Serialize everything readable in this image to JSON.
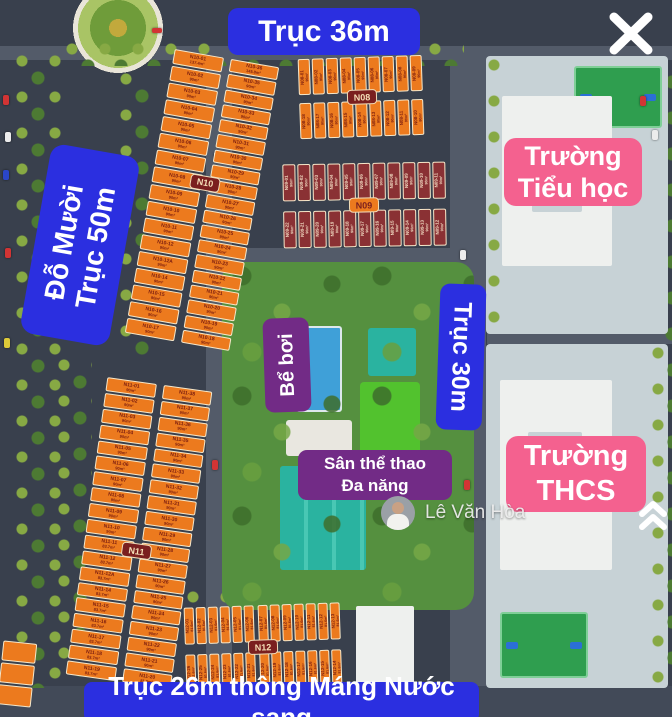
{
  "overlays": {
    "axis_top": "Trục 36m",
    "axis_left_line1": "Đỗ Mười",
    "axis_left_line2": "Trục 50m",
    "axis_right": "Trục 30m",
    "axis_bottom": "Trục 26m thông Máng Nước sang",
    "primary_school_line1": "Trường",
    "primary_school_line2": "Tiểu học",
    "secondary_school_line1": "Trường",
    "secondary_school_line2": "THCS",
    "pool": "Bể bơi",
    "sports_line1": "Sân thể thao",
    "sports_line2": "Đa năng",
    "watermark_name": "Lê Văn Hòa"
  },
  "blocks": {
    "n10": {
      "badge": "N10",
      "left": [
        {
          "id": "N10-01",
          "area": "137.4m²"
        },
        {
          "id": "N10-02",
          "area": "90m²"
        },
        {
          "id": "N10-03",
          "area": "90m²"
        },
        {
          "id": "N10-04",
          "area": "90m²"
        },
        {
          "id": "N10-05",
          "area": "90m²"
        },
        {
          "id": "N10-06",
          "area": "90m²"
        },
        {
          "id": "N10-07",
          "area": "90m²"
        },
        {
          "id": "N10-08",
          "area": "90m²"
        },
        {
          "id": "N10-09",
          "area": "90m²"
        },
        {
          "id": "N10-10",
          "area": "90m²"
        },
        {
          "id": "N10-11",
          "area": "90m²"
        },
        {
          "id": "N10-12",
          "area": "90m²"
        },
        {
          "id": "N10-12A",
          "area": "90m²"
        },
        {
          "id": "N10-14",
          "area": "90m²"
        },
        {
          "id": "N10-15",
          "area": "90m²"
        },
        {
          "id": "N10-16",
          "area": "90m²"
        },
        {
          "id": "N10-17",
          "area": "90m²"
        }
      ],
      "right": [
        {
          "id": "N10-36",
          "area": "145.8m²"
        },
        {
          "id": "N10-35",
          "area": "90m²"
        },
        {
          "id": "N10-34",
          "area": "90m²"
        },
        {
          "id": "N10-33",
          "area": "90m²"
        },
        {
          "id": "N10-32",
          "area": "90m²"
        },
        {
          "id": "N10-31",
          "area": "90m²"
        },
        {
          "id": "N10-30",
          "area": "90m²"
        },
        {
          "id": "N10-29",
          "area": "90m²"
        },
        {
          "id": "N10-28",
          "area": "90m²"
        },
        {
          "id": "N10-27",
          "area": "90m²"
        },
        {
          "id": "N10-26",
          "area": "90m²"
        },
        {
          "id": "N10-25",
          "area": "90m²"
        },
        {
          "id": "N10-24",
          "area": "90m²"
        },
        {
          "id": "N10-23",
          "area": "90m²"
        },
        {
          "id": "N10-22",
          "area": "90m²"
        },
        {
          "id": "N10-21",
          "area": "90m²"
        },
        {
          "id": "N10-20",
          "area": "90m²"
        },
        {
          "id": "N10-19",
          "area": "90m²"
        },
        {
          "id": "N10-18",
          "area": "90m²"
        }
      ]
    },
    "n11": {
      "badge": "N11",
      "left": [
        {
          "id": "N11-01",
          "area": "90m²"
        },
        {
          "id": "N11-02",
          "area": "90m²"
        },
        {
          "id": "N11-03",
          "area": "90m²"
        },
        {
          "id": "N11-04",
          "area": "90m²"
        },
        {
          "id": "N11-05",
          "area": "90m²"
        },
        {
          "id": "N11-06",
          "area": "90m²"
        },
        {
          "id": "N11-07",
          "area": "90m²"
        },
        {
          "id": "N11-08",
          "area": "90m²"
        },
        {
          "id": "N11-09",
          "area": "90m²"
        },
        {
          "id": "N11-10",
          "area": "90m²"
        },
        {
          "id": "N11-11",
          "area": "83.7m²"
        },
        {
          "id": "N11-12",
          "area": "83.7m²"
        },
        {
          "id": "N11-12A",
          "area": "83.7m²"
        },
        {
          "id": "N11-14",
          "area": "83.7m²"
        },
        {
          "id": "N11-15",
          "area": "83.7m²"
        },
        {
          "id": "N11-16",
          "area": "83.7m²"
        },
        {
          "id": "N11-17",
          "area": "83.7m²"
        },
        {
          "id": "N11-18",
          "area": "83.7m²"
        },
        {
          "id": "N11-19",
          "area": "83.7m²"
        }
      ],
      "right": [
        {
          "id": "N11-38",
          "area": "90m²"
        },
        {
          "id": "N11-37",
          "area": "90m²"
        },
        {
          "id": "N11-36",
          "area": "90m²"
        },
        {
          "id": "N11-35",
          "area": "90m²"
        },
        {
          "id": "N11-34",
          "area": "90m²"
        },
        {
          "id": "N11-33",
          "area": "90m²"
        },
        {
          "id": "N11-32",
          "area": "90m²"
        },
        {
          "id": "N11-31",
          "area": "90m²"
        },
        {
          "id": "N11-30",
          "area": "90m²"
        },
        {
          "id": "N11-29",
          "area": "90m²"
        },
        {
          "id": "N11-28",
          "area": "90m²"
        },
        {
          "id": "N11-27",
          "area": "90m²"
        },
        {
          "id": "N11-26",
          "area": "90m²"
        },
        {
          "id": "N11-25",
          "area": "90m²"
        },
        {
          "id": "N11-24",
          "area": "90m²"
        },
        {
          "id": "N11-23",
          "area": "90m²"
        },
        {
          "id": "N11-22",
          "area": "90m²"
        },
        {
          "id": "N11-21",
          "area": "90m²"
        },
        {
          "id": "N11-20",
          "area": "81.6m²"
        }
      ]
    },
    "n08": {
      "badge": "N08",
      "top": [
        {
          "id": "N08-01",
          "area": "90m²"
        },
        {
          "id": "N08-02",
          "area": "90m²"
        },
        {
          "id": "N08-03",
          "area": "90m²"
        },
        {
          "id": "N08-04",
          "area": "90m²"
        },
        {
          "id": "N08-05",
          "area": "90m²"
        },
        {
          "id": "N08-06",
          "area": "90m²"
        },
        {
          "id": "N08-07",
          "area": "90m²"
        },
        {
          "id": "N08-08",
          "area": "90m²"
        },
        {
          "id": "N08-09",
          "area": "90m²"
        }
      ],
      "bottom": [
        {
          "id": "N08-18",
          "area": "90m²"
        },
        {
          "id": "N08-17",
          "area": "90m²"
        },
        {
          "id": "N08-16",
          "area": "90m²"
        },
        {
          "id": "N08-15",
          "area": "90m²"
        },
        {
          "id": "N08-14",
          "area": "90m²"
        },
        {
          "id": "N08-13",
          "area": "90m²"
        },
        {
          "id": "N08-12",
          "area": "90m²"
        },
        {
          "id": "N08-11",
          "area": "90m²"
        },
        {
          "id": "N08-10",
          "area": "90m²"
        }
      ]
    },
    "n09": {
      "badge": "N09",
      "top_left": [
        {
          "id": "N09-01",
          "area": "90m²"
        },
        {
          "id": "N09-02",
          "area": "90m²"
        },
        {
          "id": "N09-03",
          "area": "90m²"
        },
        {
          "id": "N09-04",
          "area": "90m²"
        },
        {
          "id": "N09-05",
          "area": "90m²"
        }
      ],
      "top_right": [
        {
          "id": "N09-06",
          "area": "90m²"
        },
        {
          "id": "N09-07",
          "area": "90m²"
        },
        {
          "id": "N09-08",
          "area": "90m²"
        },
        {
          "id": "N09-09",
          "area": "90m²"
        },
        {
          "id": "N09-10",
          "area": "90m²"
        },
        {
          "id": "N09-11",
          "area": "90m²"
        }
      ],
      "bottom_left": [
        {
          "id": "N09-22",
          "area": "90m²"
        },
        {
          "id": "N09-21",
          "area": "90m²"
        },
        {
          "id": "N09-20",
          "area": "90m²"
        },
        {
          "id": "N09-19",
          "area": "90m²"
        },
        {
          "id": "N09-18",
          "area": "90m²"
        }
      ],
      "bottom_right": [
        {
          "id": "N09-17",
          "area": "90m²"
        },
        {
          "id": "N09-16",
          "area": "90m²"
        },
        {
          "id": "N09-15",
          "area": "90m²"
        },
        {
          "id": "N09-14",
          "area": "90m²"
        },
        {
          "id": "N09-13",
          "area": "90m²"
        },
        {
          "id": "N09-12",
          "area": "90m²"
        }
      ]
    },
    "n12": {
      "badge": "N12",
      "top_left": [
        {
          "id": "N12-01",
          "area": "81.6m²"
        },
        {
          "id": "N12-02",
          "area": "81.6m²"
        },
        {
          "id": "N12-03",
          "area": "81.6m²"
        },
        {
          "id": "N12-04",
          "area": "81.6m²"
        },
        {
          "id": "N12-05",
          "area": "81.6m²"
        },
        {
          "id": "N12-06",
          "area": "81.6m²"
        }
      ],
      "top_right": [
        {
          "id": "N12-07",
          "area": "81.6m²"
        },
        {
          "id": "N12-08",
          "area": "81.6m²"
        },
        {
          "id": "N12-09",
          "area": "81.6m²"
        },
        {
          "id": "N12-10",
          "area": "81.6m²"
        },
        {
          "id": "N12-11",
          "area": "81.6m²"
        },
        {
          "id": "N12-12",
          "area": "81.6m²"
        },
        {
          "id": "N12-13",
          "area": "81.6m²"
        }
      ],
      "bottom_left": [
        {
          "id": "N12-26",
          "area": "81.6m²"
        },
        {
          "id": "N12-25",
          "area": "81.6m²"
        },
        {
          "id": "N12-24",
          "area": "81.6m²"
        },
        {
          "id": "N12-23",
          "area": "81.6m²"
        },
        {
          "id": "N12-22",
          "area": "81.6m²"
        },
        {
          "id": "N12-21",
          "area": "81.6m²"
        }
      ],
      "bottom_right": [
        {
          "id": "N12-20",
          "area": "81.6m²"
        },
        {
          "id": "N12-19",
          "area": "81.6m²"
        },
        {
          "id": "N12-18",
          "area": "81.6m²"
        },
        {
          "id": "N12-17",
          "area": "81.6m²"
        },
        {
          "id": "N12-16",
          "area": "81.6m²"
        },
        {
          "id": "N12-15",
          "area": "81.6m²"
        },
        {
          "id": "N12-14",
          "area": "81.6m²"
        }
      ]
    }
  },
  "colors": {
    "axis_badge": "#2b2fe0",
    "school_badge": "#f4618f",
    "amenity_badge": "#722b86",
    "lot_orange": "#ec7a1e",
    "lot_orange_border": "#f6e7c9",
    "lot_text_maroon": "#7b1d10",
    "lot_maroon": "#8a3134",
    "lot_maroon_text": "#f3ddc4",
    "block_chip": "#7a1f1f",
    "park_green": "#55903f",
    "pool_blue": "#3fa0d8",
    "court_teal": "#2ab3a0",
    "field_green": "#52c22e",
    "campus_gray": "#c7d2d6",
    "road_dark": "#39404d"
  }
}
